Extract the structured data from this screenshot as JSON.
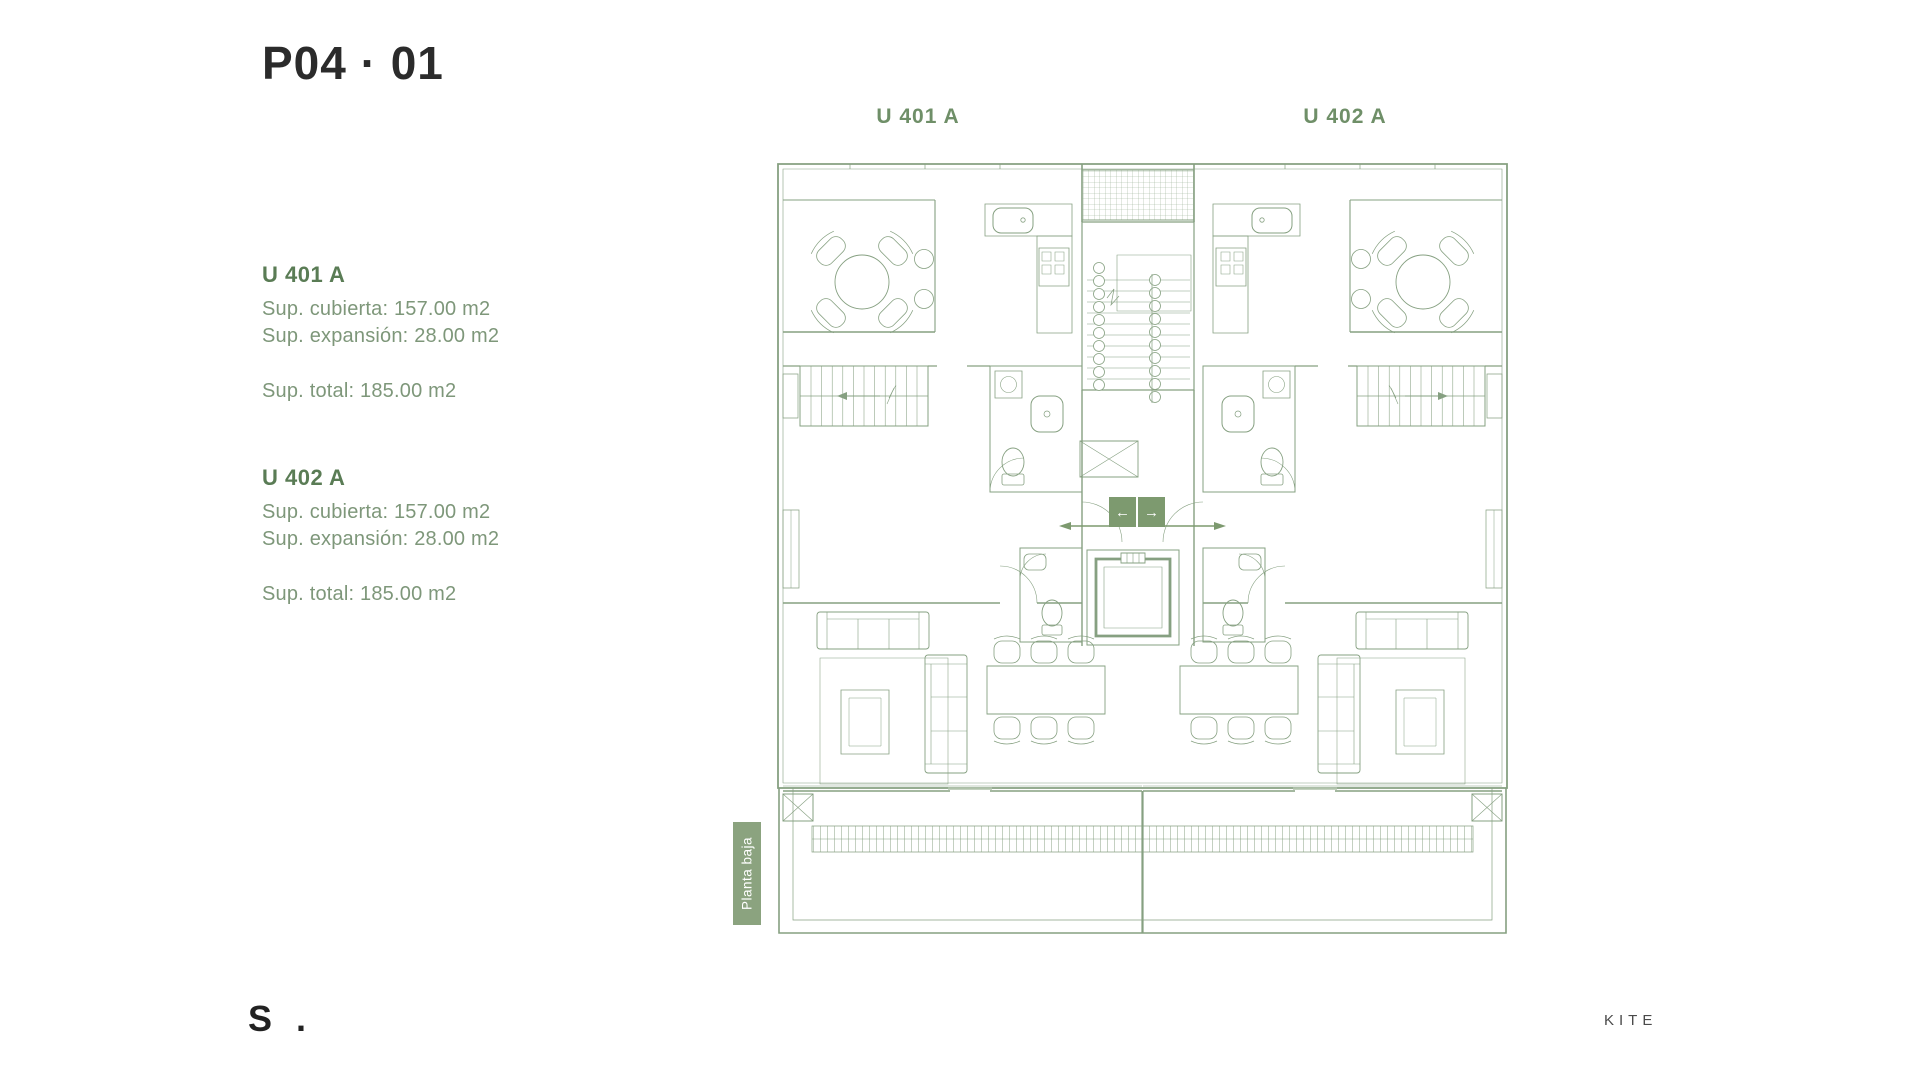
{
  "page": {
    "title": "P04 · 01",
    "footer_logo": "S .",
    "brand": "KITE"
  },
  "units": [
    {
      "name": "U 401 A",
      "covered": "Sup. cubierta: 157.00 m2",
      "expansion": "Sup. expansión: 28.00 m2",
      "total": "Sup. total: 185.00 m2"
    },
    {
      "name": "U 402 A",
      "covered": "Sup. cubierta: 157.00 m2",
      "expansion": "Sup. expansión: 28.00 m2",
      "total": "Sup. total: 185.00 m2"
    }
  ],
  "plan": {
    "label_left": "U 401 A",
    "label_right": "U 402 A",
    "floor_tag": "Planta baja",
    "elevator_arrows": [
      "←",
      "→"
    ]
  },
  "colors": {
    "title": "#2b2b2b",
    "heading_green": "#5a7c55",
    "body_green": "#7e977a",
    "plan_line": "#86a081",
    "accent_green": "#7d9a6f",
    "tag_fill": "#8ba37f"
  }
}
